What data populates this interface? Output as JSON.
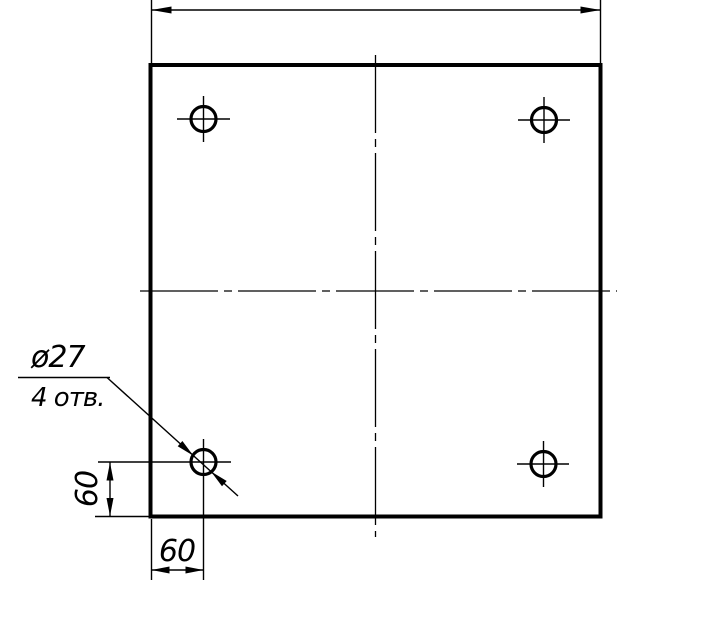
{
  "drawing": {
    "type": "engineering-drawing",
    "view": "plate-top-view",
    "colors": {
      "line": "#000000",
      "background": "#ffffff"
    },
    "callout": {
      "line1": "ø27",
      "line2": "4 отв."
    },
    "dimensions": {
      "left_vertical": "60",
      "bottom_horizontal": "60",
      "top_overall": ""
    },
    "holes_count": 4
  }
}
